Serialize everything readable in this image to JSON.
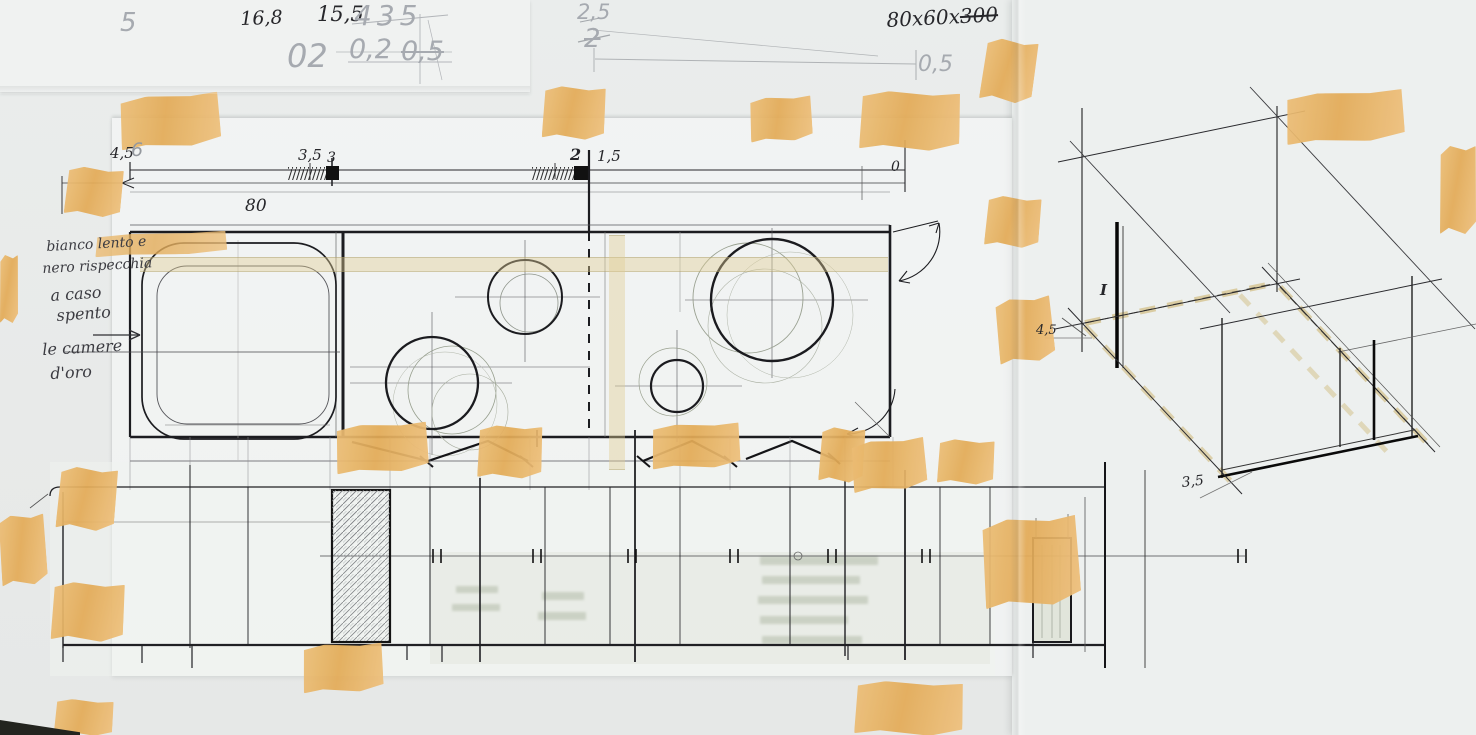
{
  "document_kind": "hand-drawn kitchen plan, elevation and axonometric sketch on taped tracing paper",
  "colors": {
    "paper": "#eaedec",
    "tape": "#e5ad5c",
    "ink": "#26262a",
    "pencil": "#a6aab0"
  },
  "pencil_notes": {
    "five": "5",
    "d435": "435",
    "d02_big": "02",
    "d0_2": "0,2",
    "d0_5_struck": "0,5",
    "d2_5": "2,5",
    "two_struck": "2",
    "d0_5_right": "0,5",
    "six": "6"
  },
  "ink_notes": {
    "d16_8": "16,8",
    "d15_5": "15,5",
    "size_prefix": "80x60x",
    "size_struck": "300"
  },
  "plan_dims": {
    "d4_5": "4,5",
    "d3_5": "3,5",
    "d3": "3",
    "d2": "2",
    "d1_5": "1,5",
    "d0": "0",
    "d80": "80"
  },
  "margin_note": {
    "l1": "bianco lento e",
    "l2": "nero rispecchia",
    "l3": "a caso",
    "l4": "spento",
    "l5": "le camere",
    "l6": "d'oro"
  },
  "isometric": {
    "d4_5": "4,5",
    "d3_5": "3,5",
    "mark": "I"
  }
}
